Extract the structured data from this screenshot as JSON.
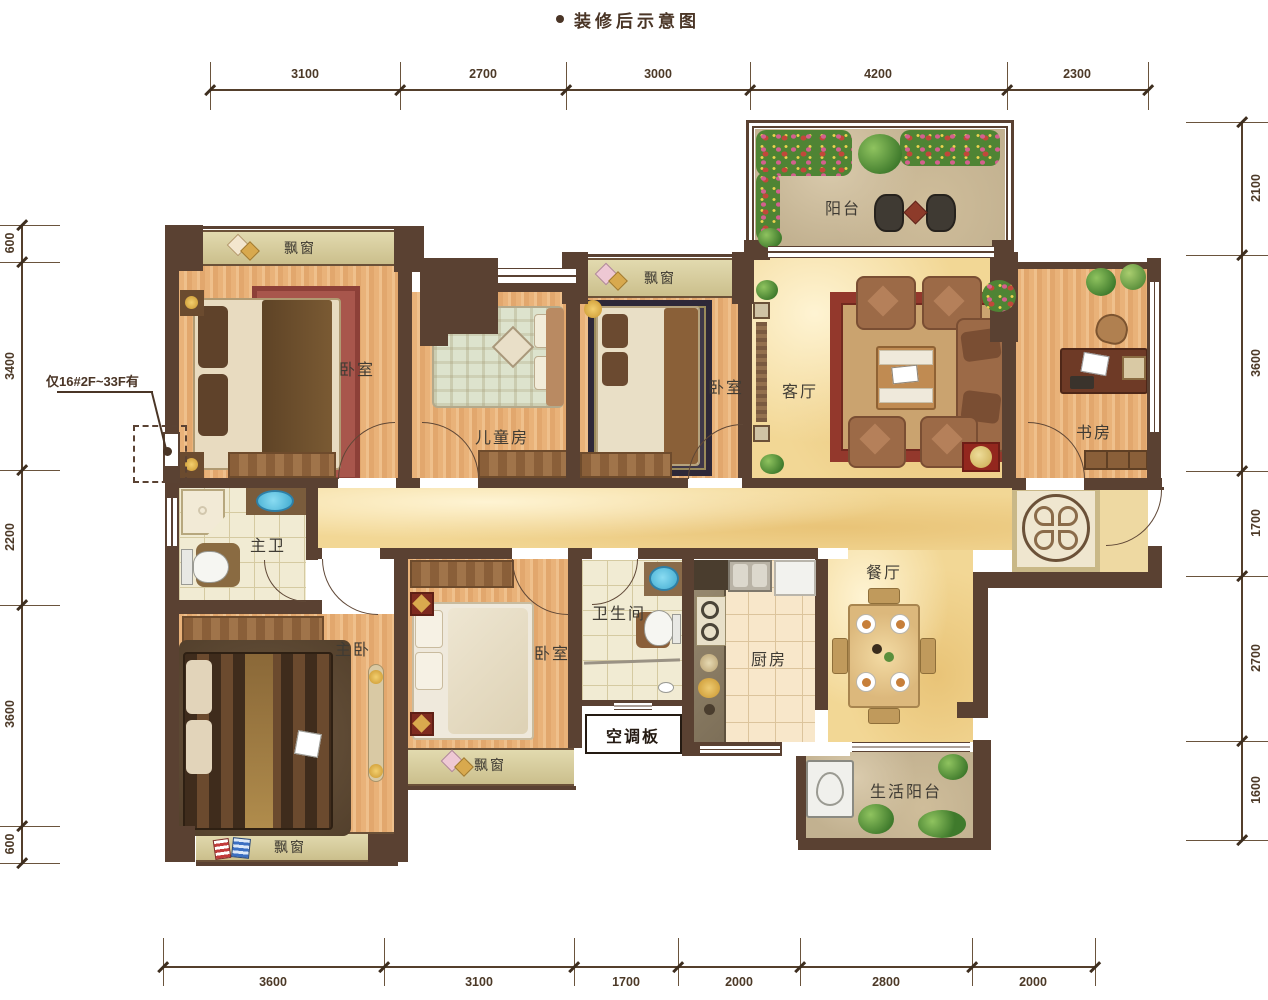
{
  "title": {
    "text": "装修后示意图"
  },
  "note": {
    "text": "仅16#2F~33F有"
  },
  "ac_panel": {
    "label": "空调板"
  },
  "rooms": {
    "bedroom_top_left": {
      "label": "卧室"
    },
    "kids_room": {
      "label": "儿童房"
    },
    "bedroom_top_mid": {
      "label": "卧室"
    },
    "living_room": {
      "label": "客厅"
    },
    "study": {
      "label": "书房"
    },
    "balcony": {
      "label": "阳台"
    },
    "master_bath": {
      "label": "主卫"
    },
    "master_bedroom": {
      "label": "主卧"
    },
    "bedroom_bottom": {
      "label": "卧室"
    },
    "bathroom": {
      "label": "卫生间"
    },
    "kitchen": {
      "label": "厨房"
    },
    "dining_room": {
      "label": "餐厅"
    },
    "service_balcony": {
      "label": "生活阳台"
    }
  },
  "bay_windows": {
    "top_left": "飘窗",
    "top_mid": "飘窗",
    "bottom_mid": "飘窗",
    "bottom_left": "飘窗"
  },
  "dimensions": {
    "top": [
      "3100",
      "2700",
      "3000",
      "4200",
      "2300"
    ],
    "bottom": [
      "3600",
      "3100",
      "1700",
      "2000",
      "2800",
      "2000"
    ],
    "left": [
      "600",
      "3400",
      "2200",
      "3600",
      "600"
    ],
    "right": [
      "2100",
      "3600",
      "1700",
      "2700",
      "1600"
    ]
  },
  "colors": {
    "wall": "#5a4132",
    "wood_floor": "#e8b077",
    "marble_floor": "#f2d795",
    "tile_floor": "#f1ebd3",
    "stone_floor": "#c2b190",
    "accent_red": "#93271e"
  }
}
